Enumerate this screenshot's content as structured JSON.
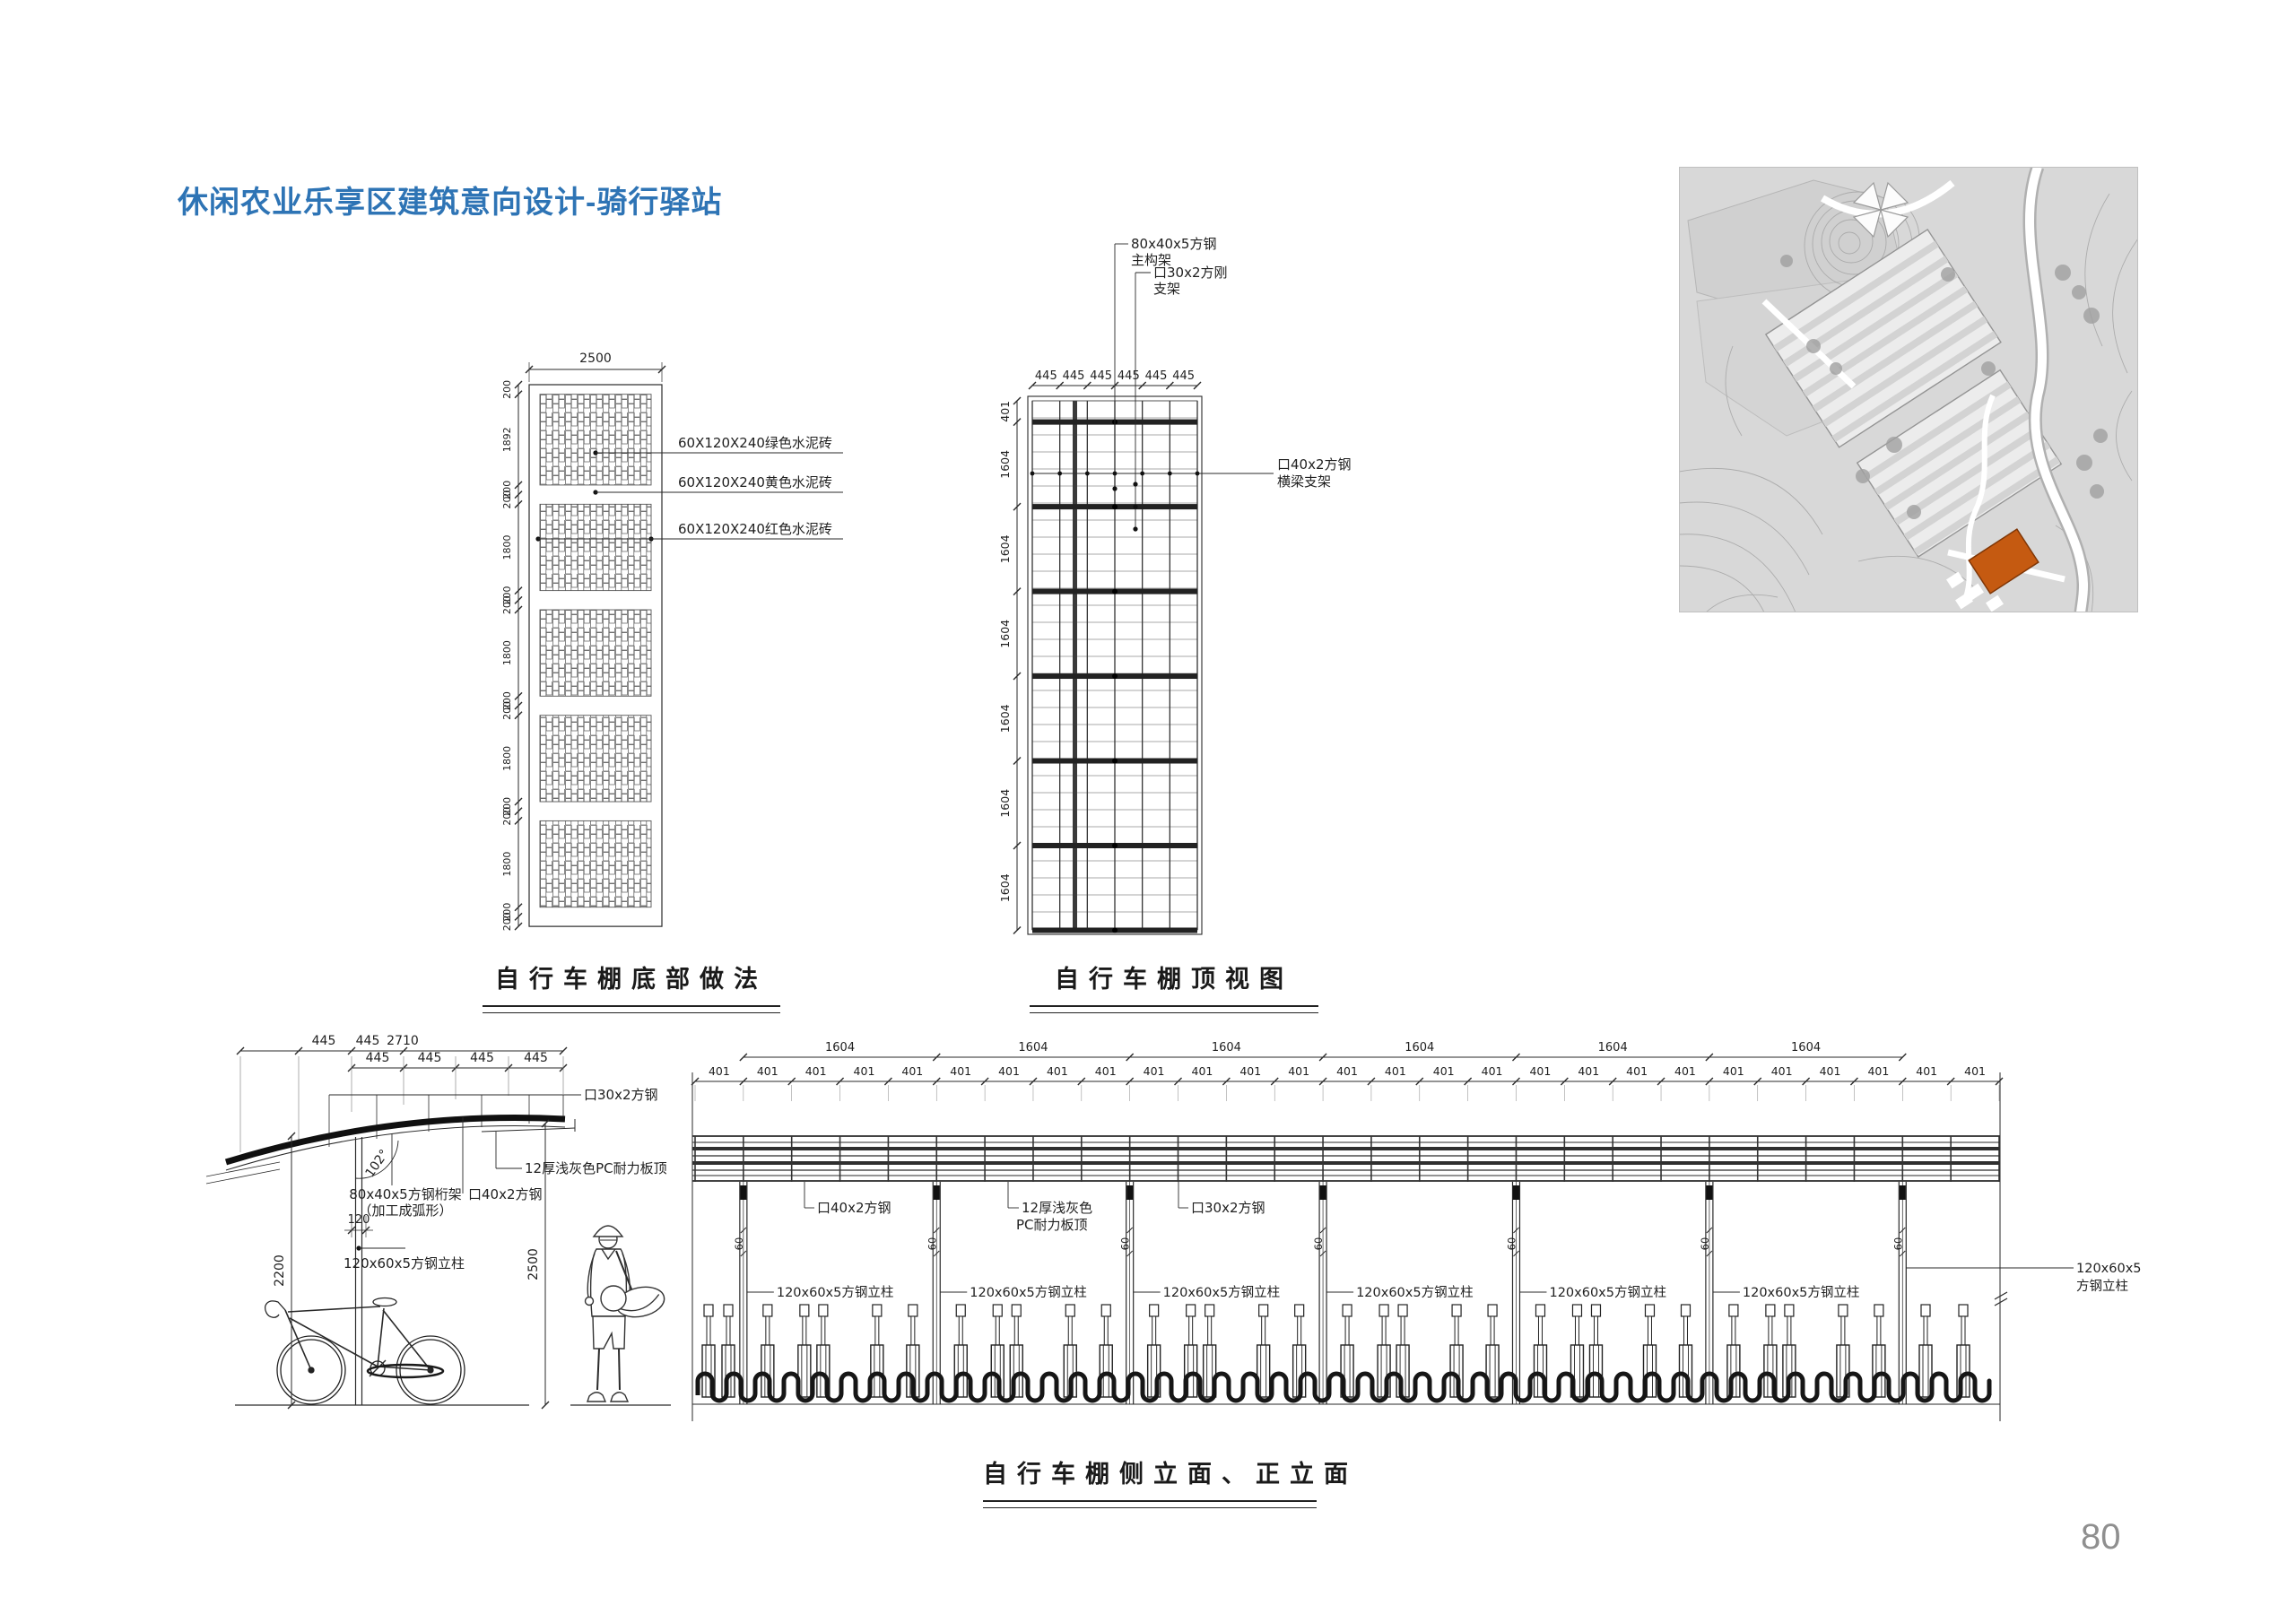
{
  "page": {
    "title": "休闲农业乐享区建筑意向设计-骑行驿站",
    "page_number": "80"
  },
  "colors": {
    "title": "#2e74b5",
    "line": "#2a2a2a",
    "dim_text": "#1f1f1f",
    "page_number": "#8f8f8f",
    "map_highlight": "#c55a11"
  },
  "bottom_detail": {
    "caption": "自行车棚底部做法",
    "top_dim": "2500",
    "left_dims": [
      "200",
      "1892",
      "200",
      "200",
      "1800",
      "200",
      "200",
      "1800",
      "200",
      "200",
      "1800",
      "200",
      "200",
      "1800",
      "200",
      "200"
    ],
    "left_dims_mm": [
      200,
      1892,
      200,
      200,
      1800,
      200,
      200,
      1800,
      200,
      200,
      1800,
      200,
      200,
      1800,
      200,
      200
    ],
    "brick_labels": [
      "60X120X240绿色水泥砖",
      "60X120X240黄色水泥砖",
      "60X120X240红色水泥砖"
    ]
  },
  "top_view": {
    "caption": "自行车棚顶视图",
    "top_dims": [
      "445",
      "445",
      "445",
      "445",
      "445",
      "445"
    ],
    "left_dims": [
      "401",
      "1604",
      "1604",
      "1604",
      "1604",
      "1604",
      "1604"
    ],
    "label_main_frame_1": "80x40x5方钢",
    "label_main_frame_2": "主构架",
    "label_support_1": "口30x2方刚",
    "label_support_2": "支架",
    "label_beam_1": "口40x2方钢",
    "label_beam_2": "横梁支架"
  },
  "side_elevation": {
    "dims_top_row1": [
      "445",
      "445",
      "2710"
    ],
    "dims_top_row2": [
      "445",
      "445",
      "445",
      "445"
    ],
    "angle_label": "102°",
    "label_roof_tube": "口30x2方钢",
    "label_truss_1": "80x40x5方钢桁架",
    "label_truss_2": "（加工成弧形）",
    "label_beam": "口40x2方钢",
    "label_panel": "12厚浅灰色PC耐力板顶",
    "label_column": "120x60x5方钢立柱",
    "dim_120": "120",
    "dim_2200": "2200",
    "dim_2500": "2500"
  },
  "front_elevation": {
    "caption": "自行车棚侧立面、正立面",
    "span_dim_label": "1604",
    "span_count": 6,
    "sub_dim_label": "401",
    "sub_count": 27,
    "post_width_label": "60",
    "label_beam": "口40x2方钢",
    "label_panel_1": "12厚浅灰色",
    "label_panel_2": "PC耐力板顶",
    "label_tube": "口30x2方钢",
    "label_column": "120x60x5方钢立柱",
    "label_column_wrap_1": "120x60x5",
    "label_column_wrap_2": "方钢立柱"
  }
}
